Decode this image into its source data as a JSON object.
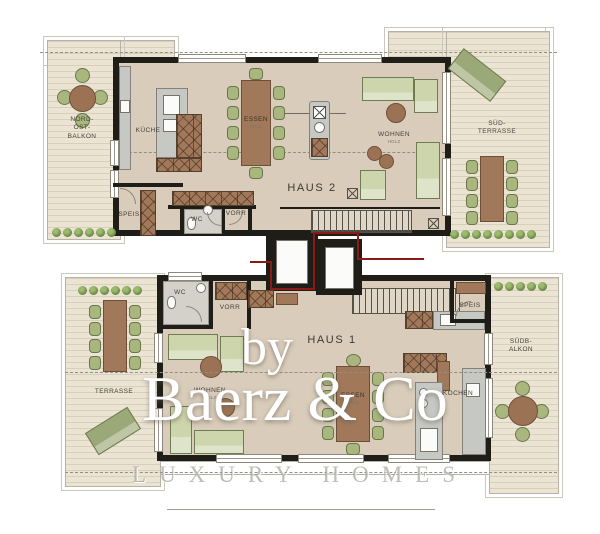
{
  "watermark": {
    "by": "by",
    "brand": "Baerz & Co",
    "tagline": "LUXURY HOMES"
  },
  "haus2": {
    "name": "HAUS 2",
    "balkon": "NORD-\nOST-\nBALKON",
    "kueche": "KÜCHE",
    "essen": "ESSEN",
    "wohnen": "WOHNEN",
    "terrasse": "SÜD-\nTERRASSE",
    "speis": "SPEIS",
    "wc": "WC",
    "vorr": "VORR"
  },
  "haus1": {
    "name": "HAUS 1",
    "terrasse": "TERRASSE",
    "wohnen": "WOHNEN",
    "essen": "ESSEN",
    "kochen": "KOCHEN",
    "speis": "SPEIS",
    "wc": "WC",
    "vorr": "VORR",
    "balkon": "SÜDB-\nALKON"
  },
  "notes": {
    "floor_material": "HOLZ"
  },
  "colors": {
    "unit_boundary": "#8b1c15",
    "wall": "#1e1d17",
    "deck": "#ece4d3",
    "floor": "#d9ccba",
    "furniture_green": "#cdd5ac",
    "furniture_brown": "#a1795a"
  }
}
